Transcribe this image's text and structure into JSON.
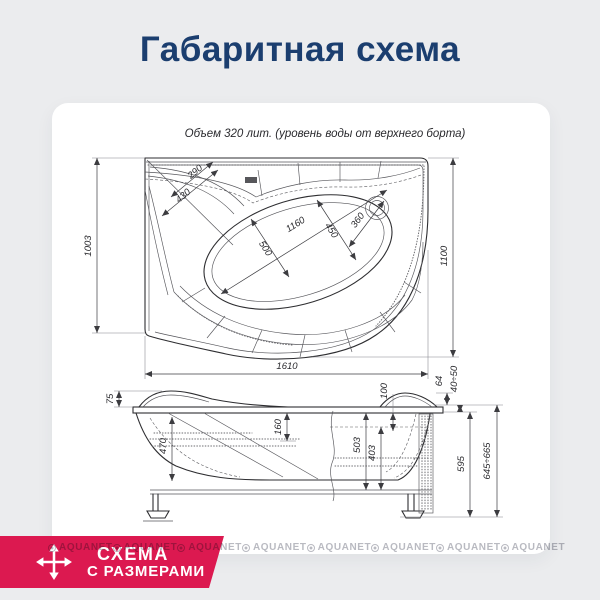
{
  "page": {
    "title": "Габаритная схема",
    "title_color": "#1b3e6f",
    "background_color": "#ebecee",
    "card_color": "#ffffff"
  },
  "drawing": {
    "volume_note": "Объем 320 лит. (уровень воды от верхнего борта)",
    "top_view": {
      "dims": {
        "left_side": "1003",
        "right_side": "1100",
        "length": "1610",
        "corner_290": "290",
        "corner_430": "430",
        "diagonal_1160": "1160",
        "width_450": "450",
        "width_500": "500",
        "drain_360": "360"
      }
    },
    "side_view": {
      "dims": {
        "rim_75": "75",
        "seat_160": "160",
        "depth_470": "470",
        "top_100": "100",
        "depth_503": "503",
        "depth_403": "403",
        "edge_64": "64",
        "range_40_50": "40÷50",
        "height_595": "595",
        "height_645_665": "645÷665"
      }
    }
  },
  "badge": {
    "line1": "СХЕМА",
    "line2": "С РАЗМЕРАМИ",
    "background_color": "#dc1950"
  },
  "watermark": {
    "text": "AQUANET",
    "count": 8
  }
}
